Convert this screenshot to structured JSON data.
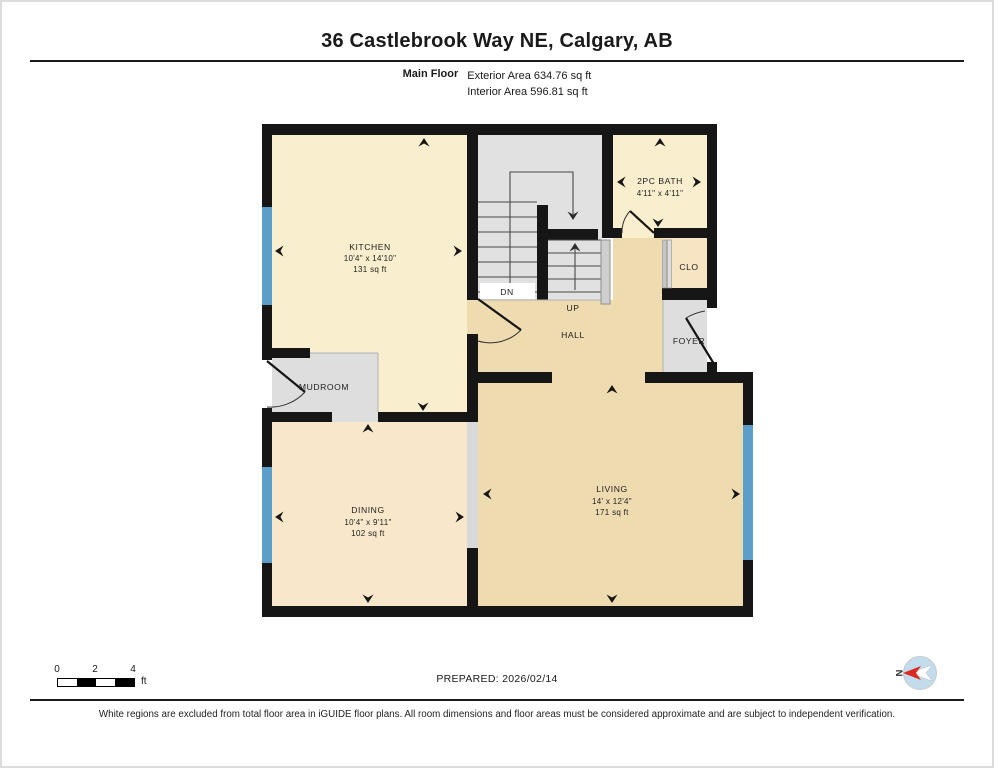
{
  "header": {
    "title": "36 Castlebrook Way NE, Calgary, AB",
    "floor_label": "Main Floor",
    "exterior_area": "Exterior Area 634.76 sq ft",
    "interior_area": "Interior Area 596.81 sq ft"
  },
  "rooms": {
    "kitchen": {
      "name": "KITCHEN",
      "dims": "10'4\" x 14'10\"",
      "area": "131 sq ft"
    },
    "bath": {
      "name": "2PC BATH",
      "dims": "4'11\" x 4'11\""
    },
    "closet": {
      "name": "CLO"
    },
    "hall": {
      "name": "HALL"
    },
    "foyer": {
      "name": "FOYER"
    },
    "mudroom": {
      "name": "MUDROOM"
    },
    "dining": {
      "name": "DINING",
      "dims": "10'4\" x 9'11\"",
      "area": "102 sq ft"
    },
    "living": {
      "name": "LIVING",
      "dims": "14' x 12'4\"",
      "area": "171 sq ft"
    },
    "stairs": {
      "down_label": "DN",
      "up_label": "UP"
    }
  },
  "footer": {
    "scale_ticks": {
      "t0": "0",
      "t2": "2",
      "t4": "4",
      "unit": "ft"
    },
    "prepared": "PREPARED: 2026/02/14",
    "compass_label": "N",
    "disclaimer": "White regions are excluded from total floor area in iGUIDE floor plans. All room dimensions and floor areas must be considered approximate and are subject to independent verification."
  },
  "colors": {
    "wall": "#161616",
    "window_blue": "#5B9EC9",
    "room_cream": "#F9EECD",
    "room_peach": "#F8E7CA",
    "room_tan": "#EEDBB0",
    "excluded_gray": "#DEDEDE",
    "compass_red": "#D92B21"
  }
}
